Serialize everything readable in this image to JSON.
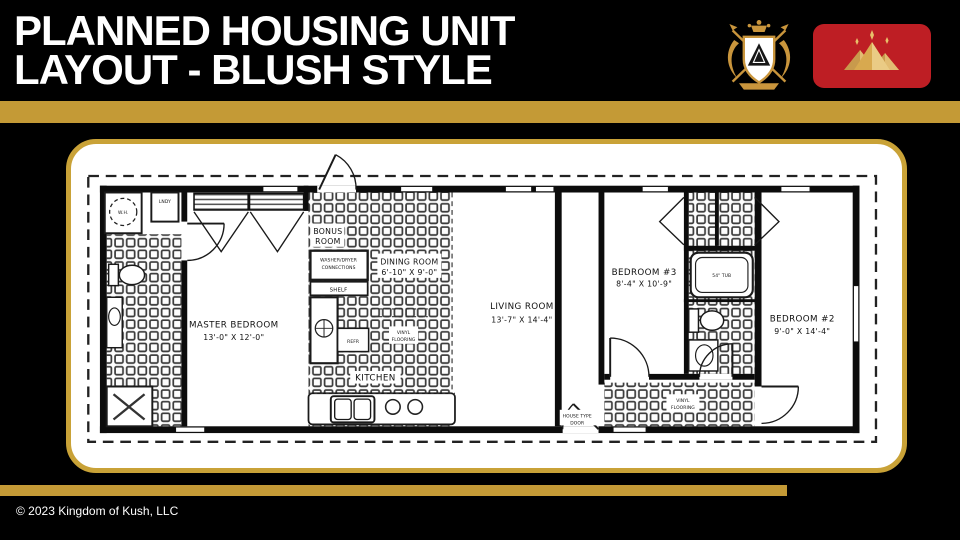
{
  "slide": {
    "title_line1": "PLANNED HOUSING UNIT",
    "title_line2": "LAYOUT - BLUSH STYLE",
    "copyright": "© 2023 Kingdom of Kush, LLC",
    "accent_gold": "#C49A36",
    "flag_red": "#BE1E24"
  },
  "floor_plan": {
    "master_bedroom": {
      "name": "MASTER BEDROOM",
      "dims": "13'-0\" X 12'-0\""
    },
    "bonus_room": {
      "line1": "BONUS",
      "line2": "ROOM"
    },
    "dining_room": {
      "name": "DINING ROOM",
      "dims": "6'-10\" X 9'-0\""
    },
    "living_room": {
      "name": "LIVING ROOM",
      "dims": "13'-7\" X 14'-4\""
    },
    "bedroom3": {
      "name": "BEDROOM #3",
      "dims": "8'-4\" X 10'-9\""
    },
    "bedroom2": {
      "name": "BEDROOM #2",
      "dims": "9'-0\" X 14'-4\""
    },
    "kitchen": {
      "name": "KITCHEN"
    },
    "labels": {
      "washer_dryer_line1": "WASHER/DRYER",
      "washer_dryer_line2": "CONNECTIONS",
      "shelf": "SHELF",
      "refr": "REFR",
      "lndy": "LNDY",
      "water_heater": "W.H.",
      "tub": "54\" TUB",
      "vinyl_line1": "VINYL",
      "vinyl_line2": "FLOORING",
      "house_door_line1": "HOUSE TYPE",
      "house_door_line2": "DOOR"
    }
  }
}
